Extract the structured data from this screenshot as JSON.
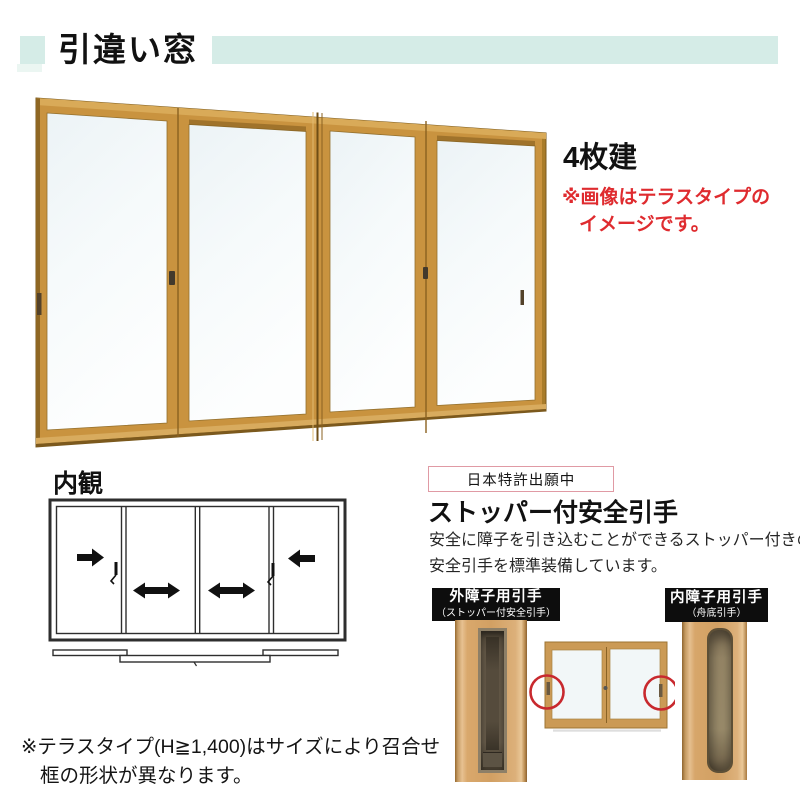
{
  "header": {
    "title": "引違い窓",
    "accent_color": "#d5ece7"
  },
  "main_figure": {
    "panel_count_label": "4枚建",
    "note_line1": "※画像はテラスタイプの",
    "note_line2": "イメージです。",
    "note_color": "#df2b2f",
    "frame_color": "#c9933f",
    "glass_color": "#f0f6f8"
  },
  "interior": {
    "heading": "内観",
    "arrows": [
      "right",
      "both-ways",
      "both-ways",
      "left"
    ]
  },
  "feature": {
    "patent_badge": "日本特許出願中",
    "patent_border_color": "#e09aa4",
    "heading": "ストッパー付安全引手",
    "body_line1": "安全に障子を引き込むことができるストッパー付きの",
    "body_line2": "安全引手を標準装備しています。",
    "outer_handle": {
      "line1": "外障子用引手",
      "line2": "（ストッパー付安全引手）"
    },
    "inner_handle": {
      "line1": "内障子用引手",
      "line2": "（舟底引手）"
    },
    "label_bg_color": "#0d0d0d",
    "highlight_circle_color": "#c8292e"
  },
  "footnote": {
    "line1": "※テラスタイプ(H≧1,400)はサイズにより召合せ",
    "line2": "框の形状が異なります。"
  }
}
